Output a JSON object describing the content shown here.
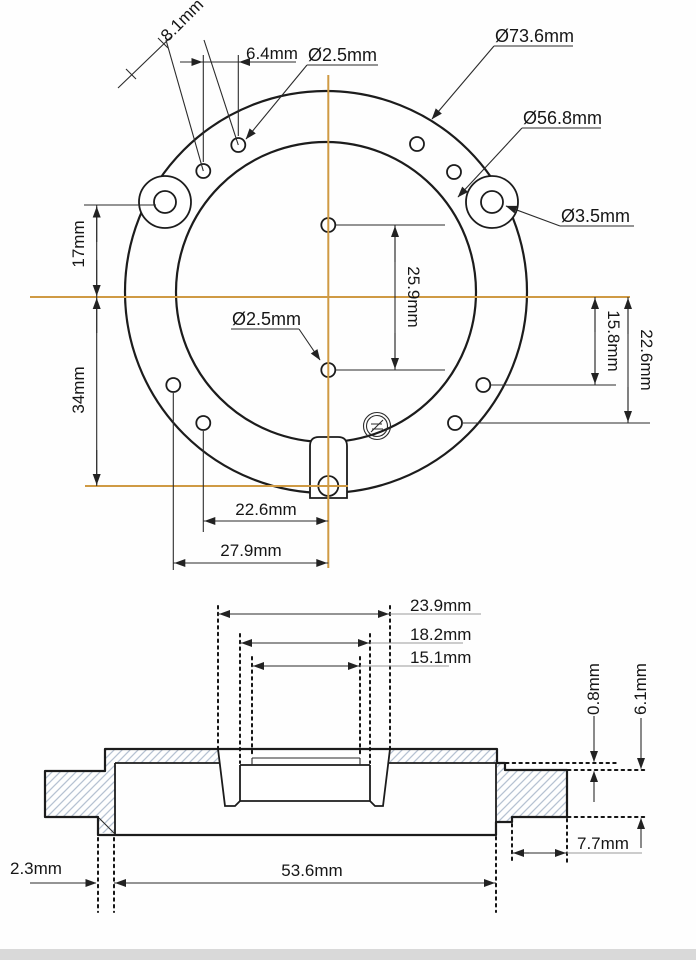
{
  "drawing": {
    "top_view": {
      "labels": {
        "dia_flange": "Ø73.6mm",
        "dia_inner": "Ø56.8mm",
        "dia_ear_hole": "Ø3.5mm",
        "dia_small_hole_top": "Ø2.5mm",
        "dia_small_hole_center": "Ø2.5mm",
        "pitch_diag": "8.1mm",
        "pitch_horiz": "6.4mm",
        "offset_top": "17mm",
        "offset_bottom": "34mm",
        "center_hole_spacing": "25.9mm",
        "offset_right_upper": "15.8mm",
        "offset_right_lower": "22.6mm",
        "offset_bottom_inner": "22.6mm",
        "offset_bottom_outer": "27.9mm"
      }
    },
    "section_view": {
      "labels": {
        "width_recess_outer": "23.9mm",
        "width_recess_mid": "18.2mm",
        "width_recess_inner": "15.1mm",
        "step_height": "0.8mm",
        "rim_height": "6.1mm",
        "rim_width": "7.7mm",
        "edge_offset": "2.3mm",
        "base_width": "53.6mm"
      }
    },
    "colors": {
      "centerline": "#cf9a44",
      "line": "#1c1c1c",
      "hatch": "#b6c2d2"
    }
  }
}
